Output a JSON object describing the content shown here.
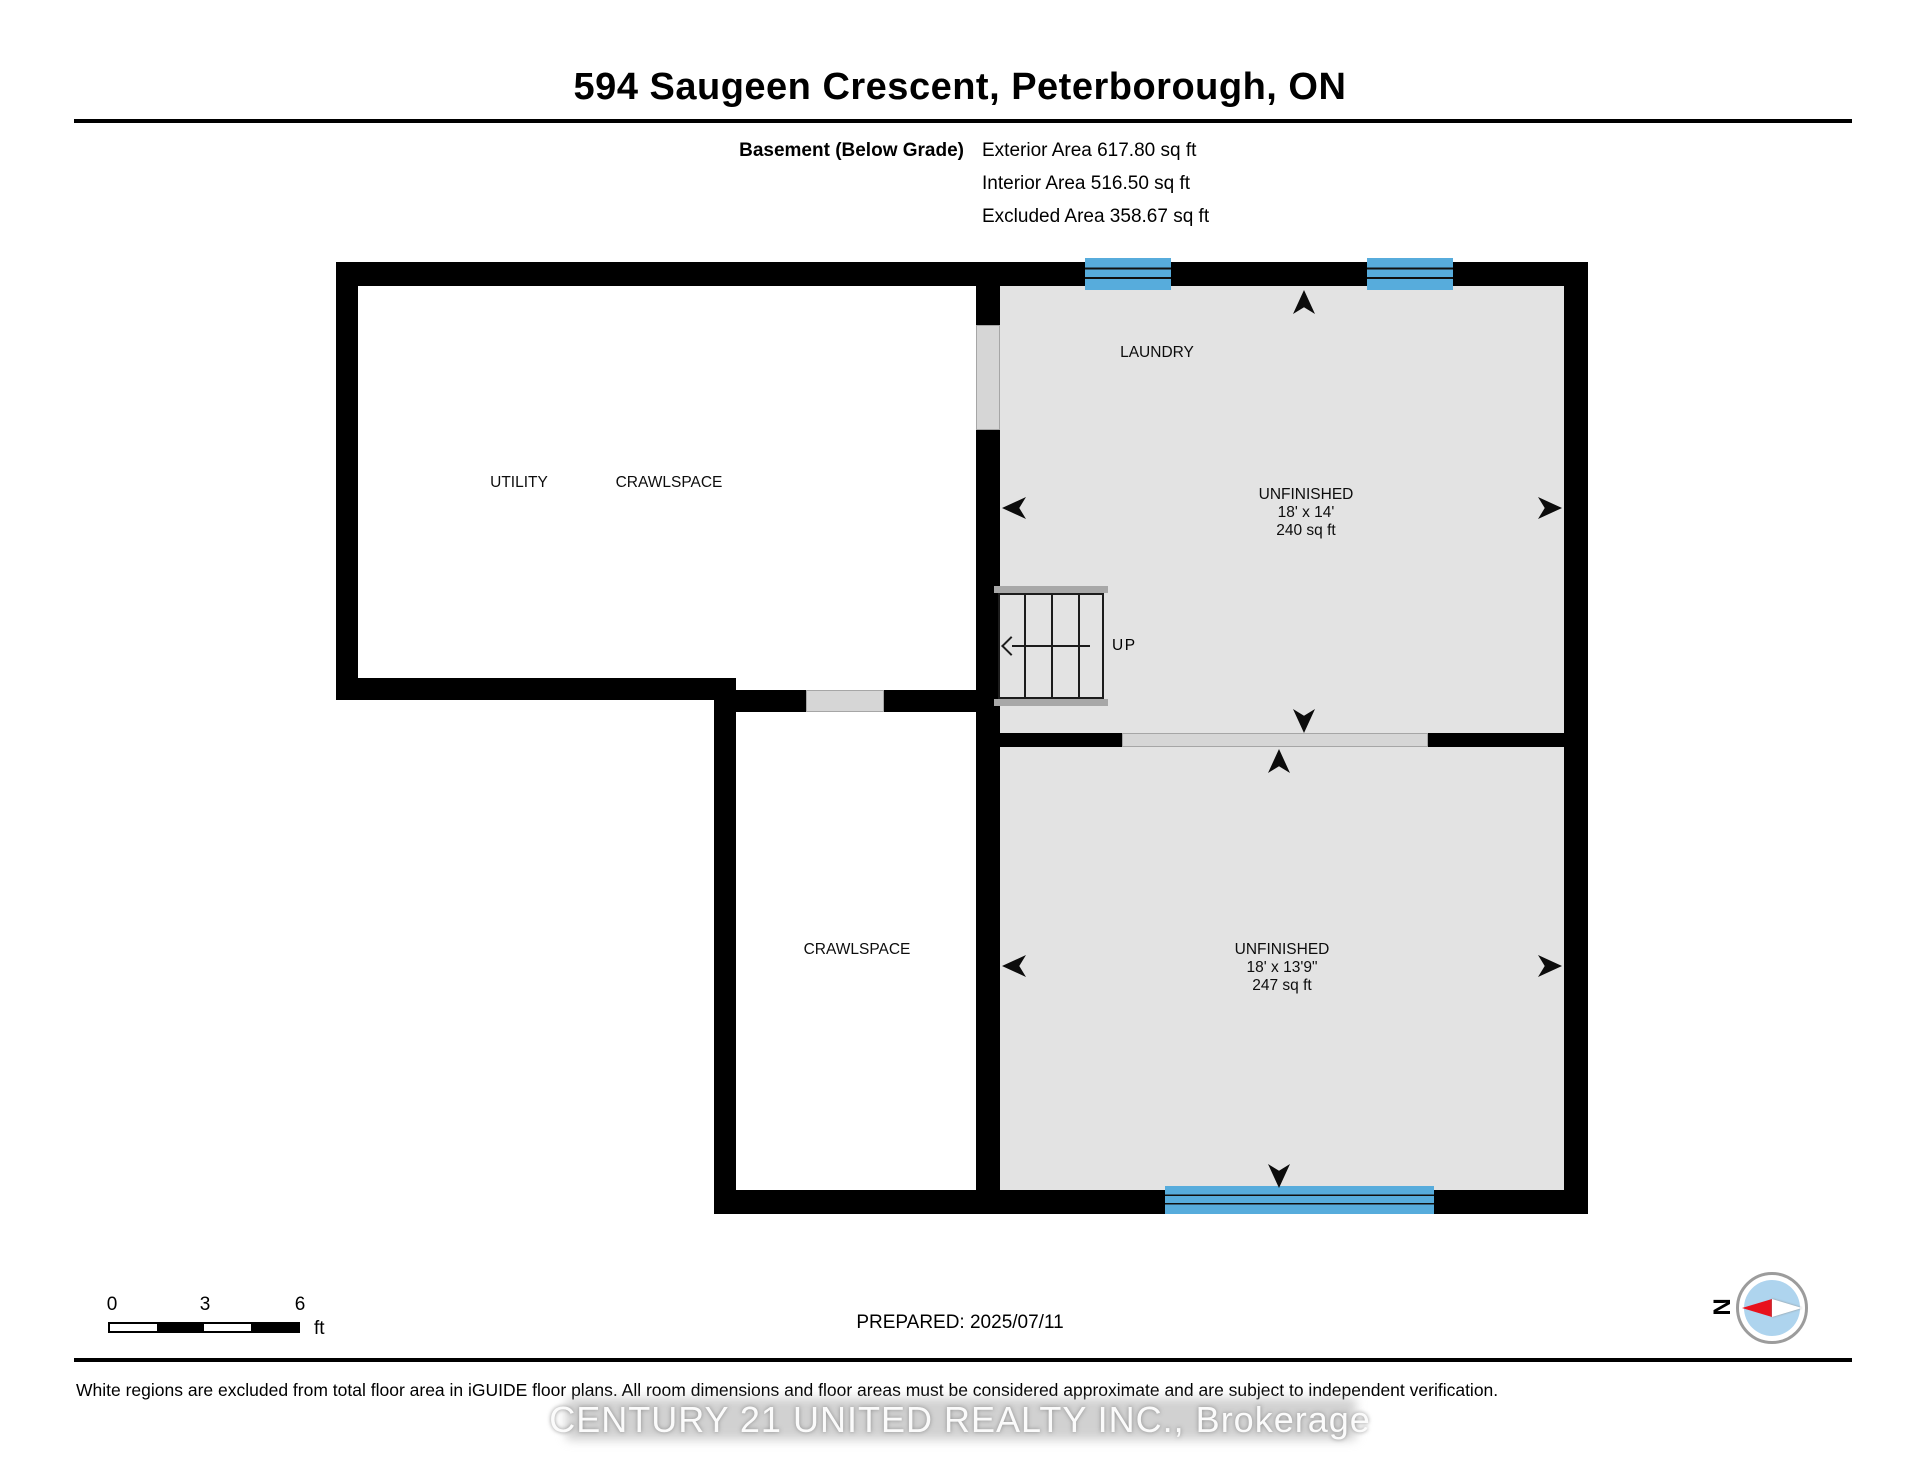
{
  "header": {
    "title": "594 Saugeen Crescent, Peterborough, ON",
    "floor_label": "Basement (Below Grade)",
    "exterior_area": "Exterior Area 617.80 sq ft",
    "interior_area": "Interior Area 516.50 sq ft",
    "excluded_area": "Excluded Area 358.67 sq ft"
  },
  "plan": {
    "rooms": [
      {
        "id": "utility",
        "label": "UTILITY"
      },
      {
        "id": "crawlspace_upper",
        "label": "CRAWLSPACE"
      },
      {
        "id": "laundry",
        "label": "LAUNDRY"
      },
      {
        "id": "unfinished_upper",
        "label": "UNFINISHED",
        "dimensions": "18' x 14'",
        "area": "240 sq ft"
      },
      {
        "id": "crawlspace_lower",
        "label": "CRAWLSPACE"
      },
      {
        "id": "unfinished_lower",
        "label": "UNFINISHED",
        "dimensions": "18' x 13'9\"",
        "area": "247 sq ft"
      }
    ],
    "stairs_label": "UP"
  },
  "scale_bar": {
    "ticks": [
      "0",
      "3",
      "6"
    ],
    "unit": "ft"
  },
  "prepared_text": "PREPARED: 2025/07/11",
  "compass": {
    "north_label": "N"
  },
  "footer_disclaimer": "White regions are excluded from total floor area in iGUIDE floor plans. All room dimensions and floor areas must be considered approximate and are subject to independent verification.",
  "watermark_text": "CENTURY 21 UNITED REALTY INC., Brokerage",
  "colors": {
    "wall": "#000000",
    "floor_included": "#e3e3e3",
    "floor_excluded": "#ffffff",
    "opening": "#d6d6d6",
    "window": "#57acdc",
    "compass_inner": "#aed4ee",
    "compass_needle": "#e8111c"
  }
}
